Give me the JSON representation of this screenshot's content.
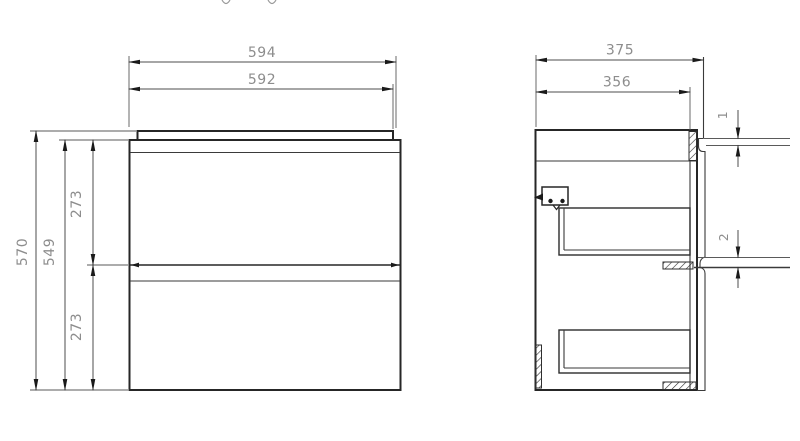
{
  "colors": {
    "background": "#ffffff",
    "object_line": "#262626",
    "dimension_line": "#4d4d4d",
    "dimension_text": "#8d8d8d"
  },
  "front_view": {
    "overall_width": "594",
    "top_panel_width": "592",
    "overall_height": "570",
    "carcass_height": "549",
    "upper_drawer_height": "273",
    "lower_drawer_height": "273"
  },
  "side_view": {
    "overall_depth": "375",
    "carcass_depth": "356",
    "top_rear_gap": "1",
    "rear_rail_gap": "2"
  }
}
